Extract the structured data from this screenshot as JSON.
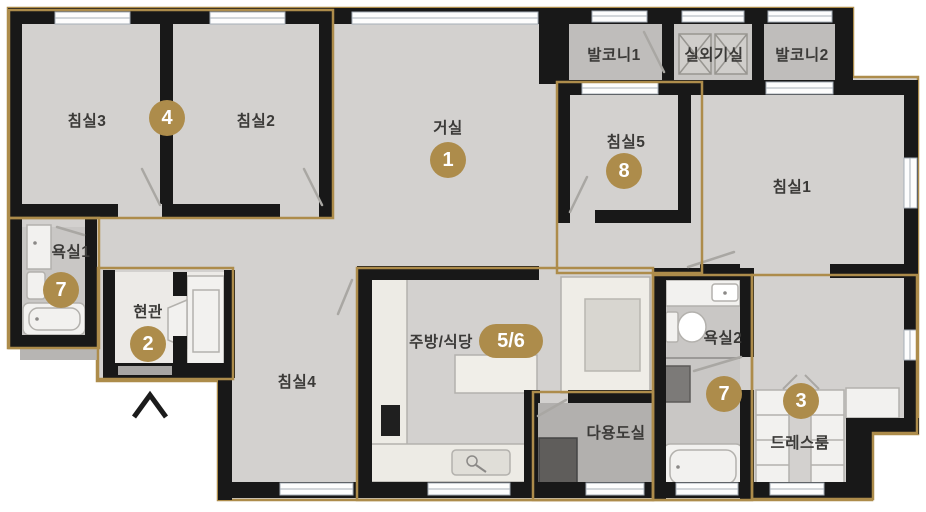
{
  "plan_type": "apartment-floorplan",
  "colors": {
    "zone_outline_gold": "#ad8c4b",
    "wall_black": "#181818",
    "floor_gray": "#d3d1cf",
    "balcony_gray": "#bfbdbb",
    "bath_gray": "#c9c7c5",
    "utility_gray": "#b2b0ae",
    "entry_white": "#eceae7",
    "fixture_white": "#f2f1ef",
    "badge_text": "#ffffff",
    "label_text": "#3b3a38"
  },
  "rooms": {
    "bedroom3": {
      "label": "침실3"
    },
    "bedroom2": {
      "label": "침실2"
    },
    "living": {
      "label": "거실",
      "badge": "1"
    },
    "balcony1": {
      "label": "발코니1"
    },
    "machine_room": {
      "label": "실외기실"
    },
    "balcony2": {
      "label": "발코니2"
    },
    "bedroom5": {
      "label": "침실5",
      "badge": "8"
    },
    "bedroom1": {
      "label": "침실1"
    },
    "bath1": {
      "label": "욕실1",
      "badge": "7"
    },
    "entry": {
      "label": "현관",
      "badge": "2"
    },
    "bedroom4": {
      "label": "침실4"
    },
    "kitchen": {
      "label": "주방/식당",
      "badge": "5/6"
    },
    "utility": {
      "label": "다용도실"
    },
    "bath2": {
      "label": "욕실2",
      "badge": "7"
    },
    "dressroom": {
      "label": "드레스룸",
      "badge": "3"
    }
  },
  "shared_badges": {
    "bedroom2_3": "4"
  }
}
